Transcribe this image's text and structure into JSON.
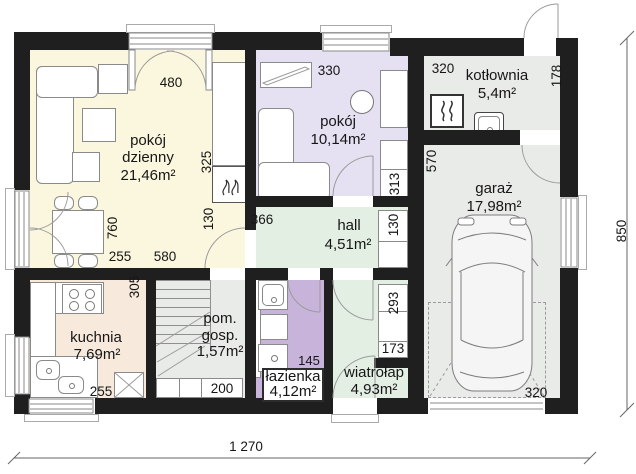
{
  "rooms": {
    "living": {
      "name": "pokój dzienny",
      "area": "21,46m²"
    },
    "bedroom": {
      "name": "pokój",
      "area": "10,14m²"
    },
    "boiler_room": {
      "name": "kotłownia",
      "area": "5,4m²"
    },
    "garage": {
      "name": "garaż",
      "area": "17,98m²"
    },
    "hall": {
      "name": "hall",
      "area": "4,51m²"
    },
    "kitchen": {
      "name": "kuchnia",
      "area": "7,69m²"
    },
    "utility_room": {
      "name": "pom. gosp.",
      "area": "1,57m²"
    },
    "bathroom": {
      "name": "łazienka",
      "area": "4,12m²"
    },
    "vestibule": {
      "name": "wiatrołap",
      "area": "4,93m²"
    }
  },
  "dimensions": {
    "total_width": "1 270",
    "total_height": "850",
    "balcony_door_width": "480",
    "bedroom_shelf_width": "330",
    "boiler_room_width": "320",
    "boiler_room_depth": "178",
    "living_cabinet_height": "325",
    "living_hall_door_width": "130",
    "hall_width": "366",
    "bedroom_cabinet_height": "313",
    "garage_interior_depth": "570",
    "hall_closet_height": "130",
    "dining_zone_depth": "760",
    "dining_zone_width": "255",
    "staircase_width": "580",
    "kitchen_zone_depth": "305",
    "vestibule_closet_height": "293",
    "vestibule_closet_width": "173",
    "kitchen_width": "255",
    "utility_cabinet_width": "200",
    "bathroom_width": "145",
    "garage_gate_width": "320"
  },
  "colors": {
    "wall": "#1e1f1e",
    "living_floor": "#fbf7df",
    "kitchen_floor": "#f7e9dc",
    "bedroom_floor": "#e6e1f2",
    "hall_floor": "#e4efe4",
    "bathroom_floor": "#c8b4da",
    "technical_floor": "#e9ebe8"
  }
}
